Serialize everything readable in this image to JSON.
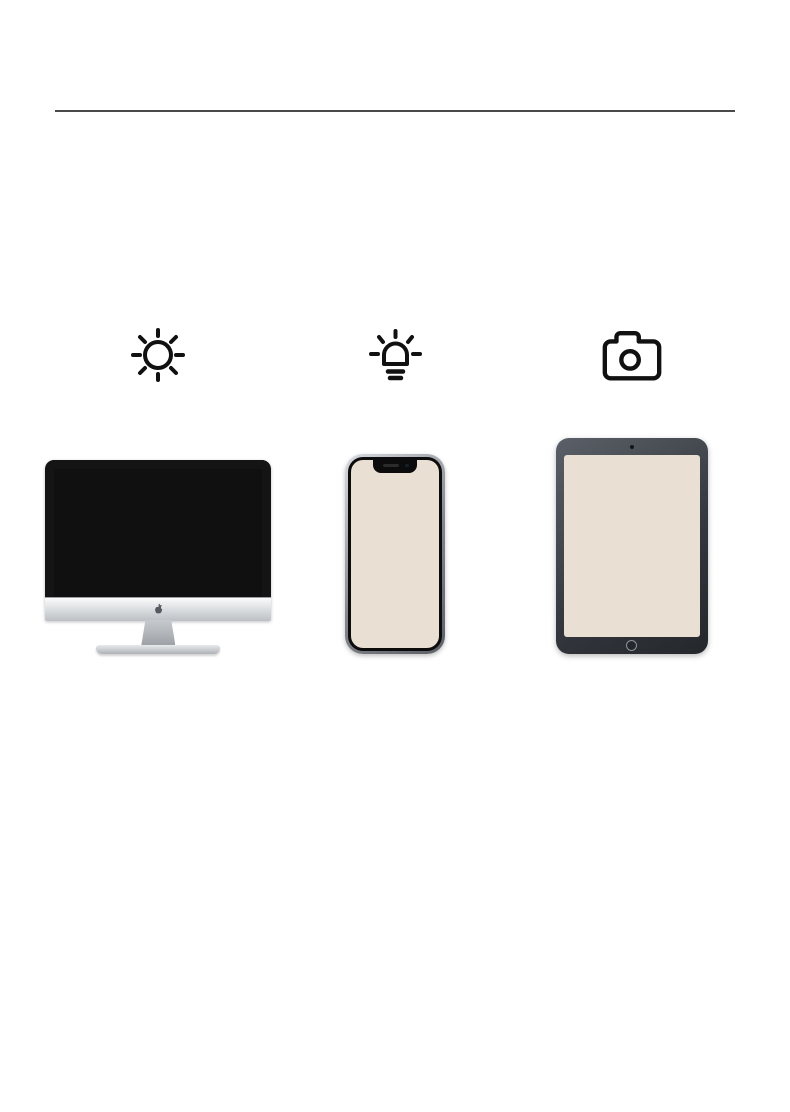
{
  "header": {
    "title": "色差说明",
    "subtitle_lines": [
      "Color",
      "Difference"
    ]
  },
  "description": {
    "lines": [
      "由于光线强弱、设备显示器差异等因素影响，可能会导致产品在画面颜",
      "色上有所差别，请以收到实物为准。"
    ]
  },
  "products": {
    "items": [
      {
        "name": "wardrobe-under-strong-light",
        "body_color": "#6e3a33",
        "shade_color": "#452420"
      },
      {
        "name": "wardrobe-under-warm-light",
        "body_color": "#6f4737",
        "shade_color": "#46291f"
      },
      {
        "name": "wardrobe-under-natural-light",
        "body_color": "#713d36",
        "shade_color": "#472622"
      }
    ]
  },
  "lighting": {
    "items": [
      {
        "icon": "sun-icon",
        "label": "强光线"
      },
      {
        "icon": "bulb-icon",
        "label": "暖光源"
      },
      {
        "icon": "camera-icon",
        "label": "自然光"
      }
    ]
  },
  "devices": {
    "items": [
      {
        "icon": "computer-mockup",
        "label": "电脑"
      },
      {
        "icon": "phone-mockup",
        "label": "手机"
      },
      {
        "icon": "tablet-mockup",
        "label": "平板电脑"
      }
    ]
  },
  "colors": {
    "text_primary": "#161616",
    "text_secondary": "#3d3d3d",
    "divider": "#4a4a4a",
    "icon_stroke": "#111111"
  }
}
